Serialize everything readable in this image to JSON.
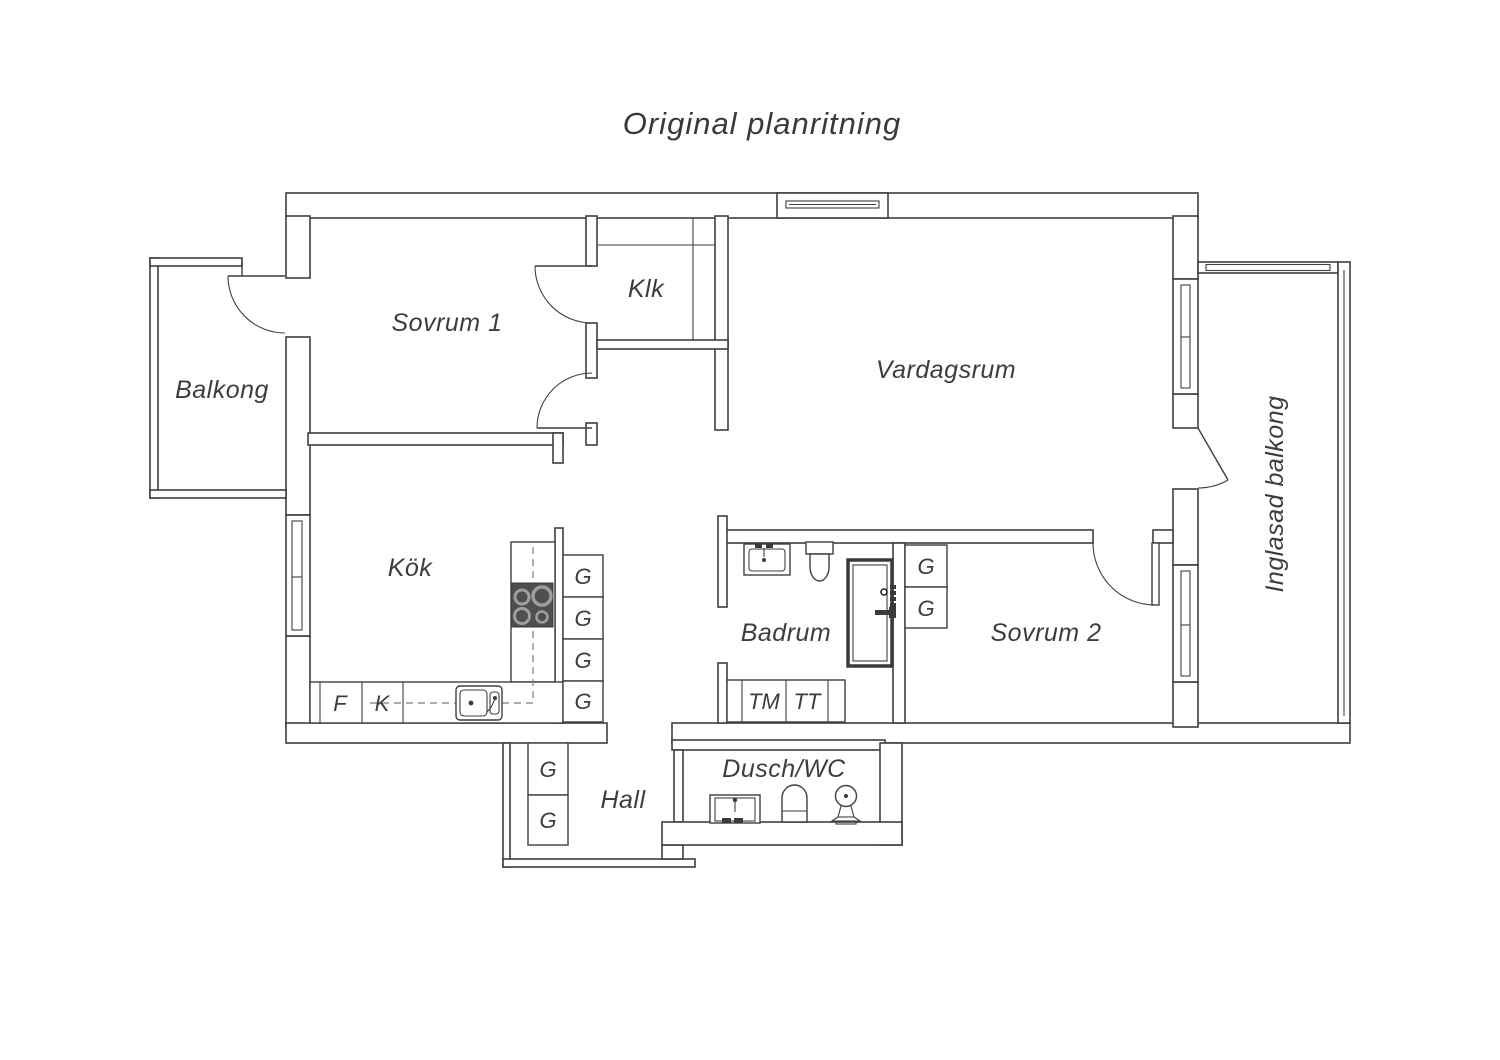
{
  "title": "Original planritning",
  "rooms": {
    "balkong": "Balkong",
    "sovrum1": "Sovrum 1",
    "klk": "Klk",
    "vardagsrum": "Vardagsrum",
    "inglasad_balkong": "Inglasad balkong",
    "kok": "Kök",
    "badrum": "Badrum",
    "sovrum2": "Sovrum 2",
    "hall": "Hall",
    "dusch_wc": "Dusch/WC"
  },
  "fixtures": {
    "garderob": "G",
    "frys": "F",
    "kyl": "K",
    "tvattmaskin": "TM",
    "torktumlare": "TT"
  },
  "colors": {
    "background": "#ffffff",
    "line": "#3f3f3f",
    "text": "#3d3d3d",
    "stove": "#4f4f4f",
    "appliance_dark": "#3a3a3a"
  }
}
